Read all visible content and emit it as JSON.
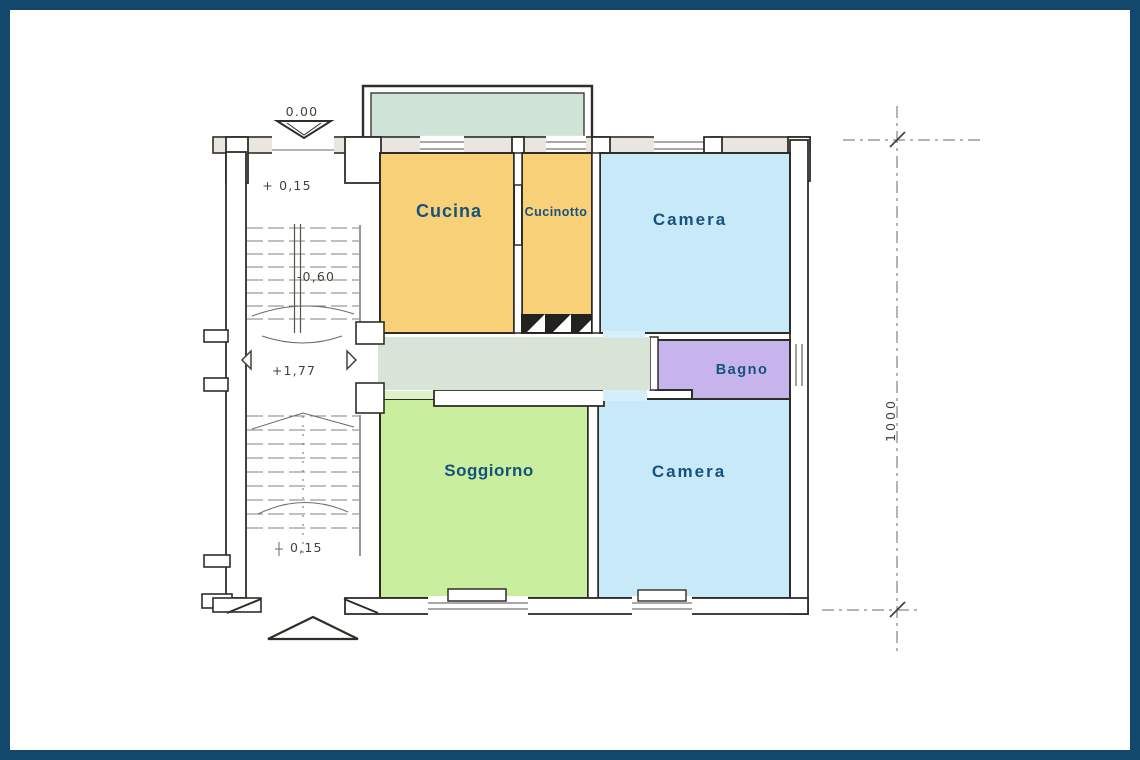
{
  "page": {
    "frame_color": "#11486B",
    "background": "#FFFFFF"
  },
  "plan": {
    "wall_color": "#2F2D28",
    "label_color": "#15537E",
    "rooms": {
      "cucina": {
        "label": "Cucina",
        "color": "#F8D077"
      },
      "cucinotto": {
        "label": "Cucinotto",
        "color": "#F8D077"
      },
      "camera_top": {
        "label": "Camera",
        "color": "#C8E9F7"
      },
      "bagno": {
        "label": "Bagno",
        "color": "#C8B4EC"
      },
      "soggiorno": {
        "label": "Soggiorno",
        "color": "#C9EE9E"
      },
      "camera_bottom": {
        "label": "Camera",
        "color": "#C8E9F7"
      }
    },
    "zones": {
      "balcony": {
        "color": "#CFE3D7"
      },
      "corridor": {
        "color": "#D8E5D6"
      },
      "door_threshold_blue": "#D6EEF9",
      "door_threshold_green": "#DDF2C6",
      "hatch_color": "#23231E"
    },
    "levels": {
      "street": "0.00",
      "upper_flight": "+ 0,15",
      "mid_flight": "-0,60",
      "landing": "+1,77",
      "lower_flight": "0,15"
    },
    "dimensions": {
      "right_vertical": "1000"
    }
  }
}
